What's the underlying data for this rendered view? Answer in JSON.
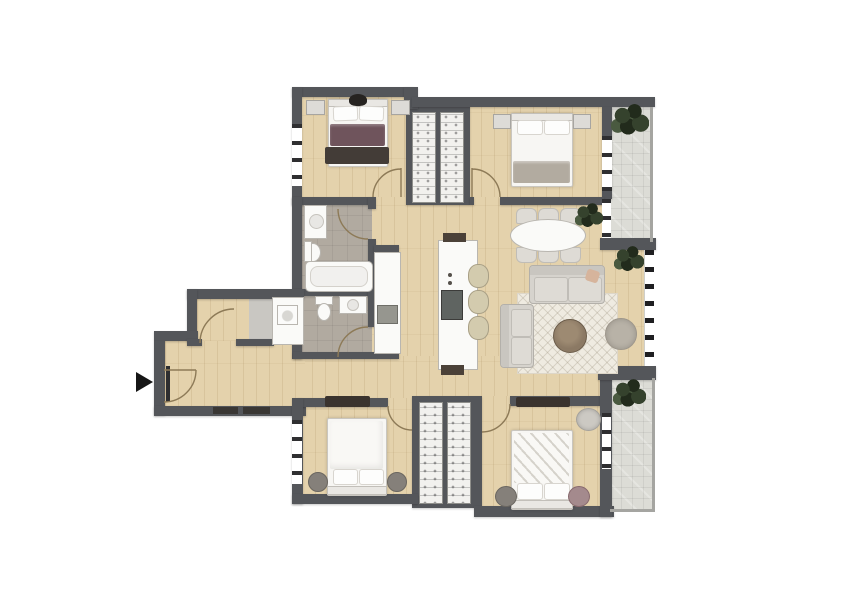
{
  "page": {
    "background": "#ffffff",
    "description": "Top-down 3D rendered apartment floor plan, no text labels"
  },
  "palette": {
    "wall": "#54565a",
    "wood": "#e4d2ac",
    "tile": "#dcdcd6",
    "bath_floor": "#b1aaa0",
    "utility_floor": "#c9c7c2",
    "fixture_white": "#fafaf8",
    "fixture_border": "#b9b6b0",
    "railing": "#a5a5a1",
    "sofa": "#d6d3cd",
    "rug_light": "#efebe1",
    "rug_dark": "#3a332e",
    "blanket_purple": "#6f545c",
    "blanket_gray": "#b2aba0",
    "table_brown": "#8b7964",
    "pouf": "#b8b2a7",
    "pouf_dark": "#85807a",
    "pouf_mauve": "#a48a8d",
    "plant": "#35422d",
    "plant_dark": "#222b1c",
    "stool": "#d3cbae",
    "cooktop": "#5f6461",
    "appliance": "#96968f",
    "door_arc": "#8d7a57",
    "arrow": "#161616"
  },
  "rooms": [
    {
      "id": "bedroom-top-left",
      "label": "Bedroom (top left) with double bed"
    },
    {
      "id": "bedroom-top-right",
      "label": "Bedroom (top right) with double bed"
    },
    {
      "id": "wardrobe-nook-top",
      "label": "Built-in wardrobes (top)"
    },
    {
      "id": "living-dining",
      "label": "Open living / dining room"
    },
    {
      "id": "kitchen",
      "label": "Kitchen with island"
    },
    {
      "id": "bathroom-1",
      "label": "Bathroom with bathtub"
    },
    {
      "id": "bathroom-2",
      "label": "Second bathroom / WC"
    },
    {
      "id": "storage-laundry",
      "label": "Storage / laundry room"
    },
    {
      "id": "entrance-hall",
      "label": "Entrance hall"
    },
    {
      "id": "bedroom-bottom-left",
      "label": "Bedroom (bottom left) with double bed"
    },
    {
      "id": "bedroom-bottom-right",
      "label": "Bedroom (bottom right) with double bed"
    },
    {
      "id": "wardrobe-nook-bottom",
      "label": "Built-in wardrobes (bottom)"
    },
    {
      "id": "balcony-top",
      "label": "Balcony (upper right)"
    },
    {
      "id": "balcony-bottom",
      "label": "Balcony (lower right)"
    }
  ],
  "furniture_inventory": {
    "bedroom-top-left": [
      "double bed with purple blanket",
      "two nightstands",
      "dark rug",
      "dark decor on headboard"
    ],
    "bedroom-top-right": [
      "double bed with gray throw",
      "two nightstands"
    ],
    "living-dining": [
      "oval dining table",
      "six dining chairs",
      "sofa",
      "loveseat",
      "round coffee table",
      "pouf",
      "area rug",
      "potted plant"
    ],
    "kitchen": [
      "island with cooktop",
      "three bar stools",
      "counter with oven"
    ],
    "bathroom-1": [
      "vanity sink",
      "toilet",
      "bathtub"
    ],
    "bathroom-2": [
      "toilet",
      "wash basin"
    ],
    "storage-laundry": [
      "washing machine",
      "closet"
    ],
    "bedroom-bottom-left": [
      "double bed",
      "two round poufs",
      "dark runner rug"
    ],
    "bedroom-bottom-right": [
      "double bed with rumpled duvet",
      "two round poufs",
      "round chair",
      "dark runner rug"
    ],
    "balconies": [
      "four potted plants",
      "tiled floor",
      "railings"
    ]
  },
  "markers": {
    "entrance_arrow": "Black triangle arrow pointing right at the apartment entrance"
  }
}
